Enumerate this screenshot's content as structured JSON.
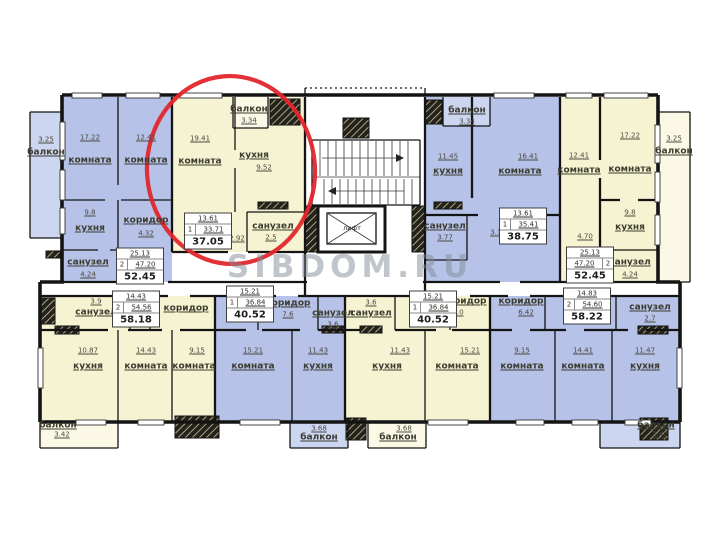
{
  "watermark": {
    "text": "SIBDOM.RU"
  },
  "colors": {
    "room_blue": "#b6c2e7",
    "balcony_blue": "#ccd6f0",
    "room_yellow": "#f6f3d2",
    "balcony_yellow": "#fbf9e6",
    "wall": "#141414",
    "highlight_red": "#e1262c",
    "watermark_gray": "#828c98"
  },
  "elevator": {
    "label": "лифт"
  },
  "rooms": [
    {
      "k": "balcony",
      "t": "балкон",
      "n": "3.25",
      "x": 46,
      "y": 153,
      "nx": 46,
      "ny": 140
    },
    {
      "k": "room",
      "t": "комната",
      "n": "17.22",
      "x": 90,
      "y": 161,
      "nx": 90,
      "ny": 138
    },
    {
      "k": "room",
      "t": "комната",
      "n": "12.41",
      "x": 146,
      "y": 161,
      "nx": 146,
      "ny": 138
    },
    {
      "k": "kitchen",
      "t": "кухня",
      "n": "9.8",
      "x": 90,
      "y": 229,
      "nx": 90,
      "ny": 213
    },
    {
      "k": "corridor",
      "t": "коридор",
      "n": "4.32",
      "x": 146,
      "y": 221,
      "nx": 146,
      "ny": 234
    },
    {
      "k": "bathroom",
      "t": "санузел",
      "n": "4.24",
      "x": 88,
      "y": 263,
      "nx": 88,
      "ny": 275
    },
    {
      "k": "room",
      "t": "комната",
      "n": "19.41",
      "x": 200,
      "y": 162,
      "nx": 200,
      "ny": 139
    },
    {
      "k": "kitchen",
      "t": "кухня",
      "n": "9.52",
      "x": 254,
      "y": 156,
      "nx": 264,
      "ny": 168
    },
    {
      "k": "balcony",
      "t": "балкон",
      "n": "3.34",
      "x": 249,
      "y": 110,
      "nx": 249,
      "ny": 121
    },
    {
      "k": "bathroom",
      "t": "санузел",
      "n": "2.5",
      "x": 273,
      "y": 227,
      "nx": 271,
      "ny": 238
    },
    {
      "k": "dim",
      "n": "2.92",
      "nx": 237,
      "ny": 239
    },
    {
      "k": "balcony",
      "t": "балкон",
      "n": "3.34",
      "x": 467,
      "y": 111,
      "nx": 467,
      "ny": 122
    },
    {
      "k": "kitchen",
      "t": "кухня",
      "n": "11.45",
      "x": 448,
      "y": 172,
      "nx": 448,
      "ny": 157
    },
    {
      "k": "room",
      "t": "комната",
      "n": "16.41",
      "x": 520,
      "y": 172,
      "nx": 528,
      "ny": 157
    },
    {
      "k": "bathroom",
      "t": "санузел",
      "n": "3.77",
      "x": 445,
      "y": 227,
      "nx": 445,
      "ny": 238
    },
    {
      "k": "dim",
      "n": "3.12",
      "nx": 498,
      "ny": 233
    },
    {
      "k": "room",
      "t": "комната",
      "n": "12.41",
      "x": 579,
      "y": 171,
      "nx": 579,
      "ny": 156
    },
    {
      "k": "room",
      "t": "комната",
      "n": "17.22",
      "x": 630,
      "y": 170,
      "nx": 630,
      "ny": 136
    },
    {
      "k": "kitchen",
      "t": "кухня",
      "n": "9.8",
      "x": 630,
      "y": 228,
      "nx": 630,
      "ny": 213
    },
    {
      "k": "dim",
      "n": "4.70",
      "nx": 585,
      "ny": 237
    },
    {
      "k": "bathroom",
      "t": "санузел",
      "n": "4.24",
      "x": 630,
      "y": 263,
      "nx": 630,
      "ny": 275
    },
    {
      "k": "balcony",
      "t": "балкон",
      "n": "3.25",
      "x": 674,
      "y": 152,
      "nx": 674,
      "ny": 139
    },
    {
      "k": "bathroom",
      "t": "санузел",
      "n": "3.9",
      "x": 96,
      "y": 313,
      "nx": 96,
      "ny": 302
    },
    {
      "k": "corridor",
      "t": "коридор",
      "x": 186,
      "y": 309
    },
    {
      "k": "kitchen",
      "t": "кухня",
      "n": "10.87",
      "x": 88,
      "y": 367,
      "nx": 88,
      "ny": 351
    },
    {
      "k": "room",
      "t": "комната",
      "n": "14.43",
      "x": 146,
      "y": 367,
      "nx": 146,
      "ny": 351
    },
    {
      "k": "room",
      "t": "комната",
      "n": "9.15",
      "x": 194,
      "y": 367,
      "nx": 197,
      "ny": 351
    },
    {
      "k": "corridor",
      "t": "коридор",
      "n": "7.6",
      "x": 288,
      "y": 304,
      "nx": 288,
      "ny": 315
    },
    {
      "k": "bathroom",
      "t": "санузел",
      "n": "3.6",
      "x": 333,
      "y": 314,
      "nx": 333,
      "ny": 325
    },
    {
      "k": "room",
      "t": "комната",
      "n": "15.21",
      "x": 253,
      "y": 367,
      "nx": 253,
      "ny": 351
    },
    {
      "k": "kitchen",
      "t": "кухня",
      "n": "11.43",
      "x": 318,
      "y": 367,
      "nx": 318,
      "ny": 351
    },
    {
      "k": "bathroom",
      "t": "санузел",
      "n": "3.6",
      "x": 371,
      "y": 314,
      "nx": 371,
      "ny": 303
    },
    {
      "k": "kitchen",
      "t": "кухня",
      "n": "11.43",
      "x": 387,
      "y": 367,
      "nx": 400,
      "ny": 351
    },
    {
      "k": "room",
      "t": "комната",
      "n": "15.21",
      "x": 457,
      "y": 367,
      "nx": 470,
      "ny": 351
    },
    {
      "k": "corridor",
      "t": "коридор",
      "n": "7.0",
      "x": 464,
      "y": 302,
      "nx": 458,
      "ny": 313
    },
    {
      "k": "corridor",
      "t": "коридор",
      "n": "6.42",
      "x": 521,
      "y": 302,
      "nx": 526,
      "ny": 313
    },
    {
      "k": "bathroom",
      "t": "санузел",
      "n": "2.7",
      "x": 650,
      "y": 308,
      "nx": 650,
      "ny": 319
    },
    {
      "k": "room",
      "t": "комната",
      "n": "9.15",
      "x": 522,
      "y": 367,
      "nx": 522,
      "ny": 351
    },
    {
      "k": "room",
      "t": "комната",
      "n": "14.41",
      "x": 583,
      "y": 367,
      "nx": 583,
      "ny": 351
    },
    {
      "k": "kitchen",
      "t": "кухня",
      "n": "11.47",
      "x": 645,
      "y": 367,
      "nx": 645,
      "ny": 351
    },
    {
      "k": "balcony",
      "t": "балкон",
      "n": "3.42",
      "x": 58,
      "y": 426,
      "nx": 62,
      "ny": 435
    },
    {
      "k": "balcony",
      "t": "балкон",
      "n": "3.68",
      "x": 319,
      "y": 438,
      "nx": 319,
      "ny": 429
    },
    {
      "k": "balcony",
      "t": "балкон",
      "n": "3.68",
      "x": 398,
      "y": 438,
      "nx": 404,
      "ny": 429
    },
    {
      "k": "balcony",
      "t": "балкон",
      "n": "3.42",
      "x": 656,
      "y": 426,
      "nx": 660,
      "ny": 435
    },
    {
      "k": "elevator",
      "t": "лифт",
      "x": 352,
      "y": 228,
      "lift": true
    }
  ],
  "stamps": [
    {
      "rooms": "2",
      "living": "25.13",
      "area": "47.20",
      "total": "52.45",
      "x": 140,
      "y": 266
    },
    {
      "rooms": "1",
      "living": "13.61",
      "area": "33.71",
      "total": "37.05",
      "x": 208,
      "y": 231
    },
    {
      "rooms": "1",
      "living": "13.61",
      "area": "35.41",
      "total": "38.75",
      "x": 523,
      "y": 226
    },
    {
      "rooms": "2",
      "living": "25.13",
      "area": "47.20",
      "total": "52.45",
      "x": 590,
      "y": 265,
      "flip": true
    },
    {
      "rooms": "2",
      "living": "14.43",
      "area": "54.56",
      "total": "58.18",
      "x": 136,
      "y": 309
    },
    {
      "rooms": "1",
      "living": "15.21",
      "area": "36.84",
      "total": "40.52",
      "x": 250,
      "y": 304
    },
    {
      "rooms": "1",
      "living": "15.21",
      "area": "36.84",
      "total": "40.52",
      "x": 433,
      "y": 309
    },
    {
      "rooms": "2",
      "living": "14.83",
      "area": "54.60",
      "total": "58.22",
      "x": 587,
      "y": 306
    }
  ]
}
